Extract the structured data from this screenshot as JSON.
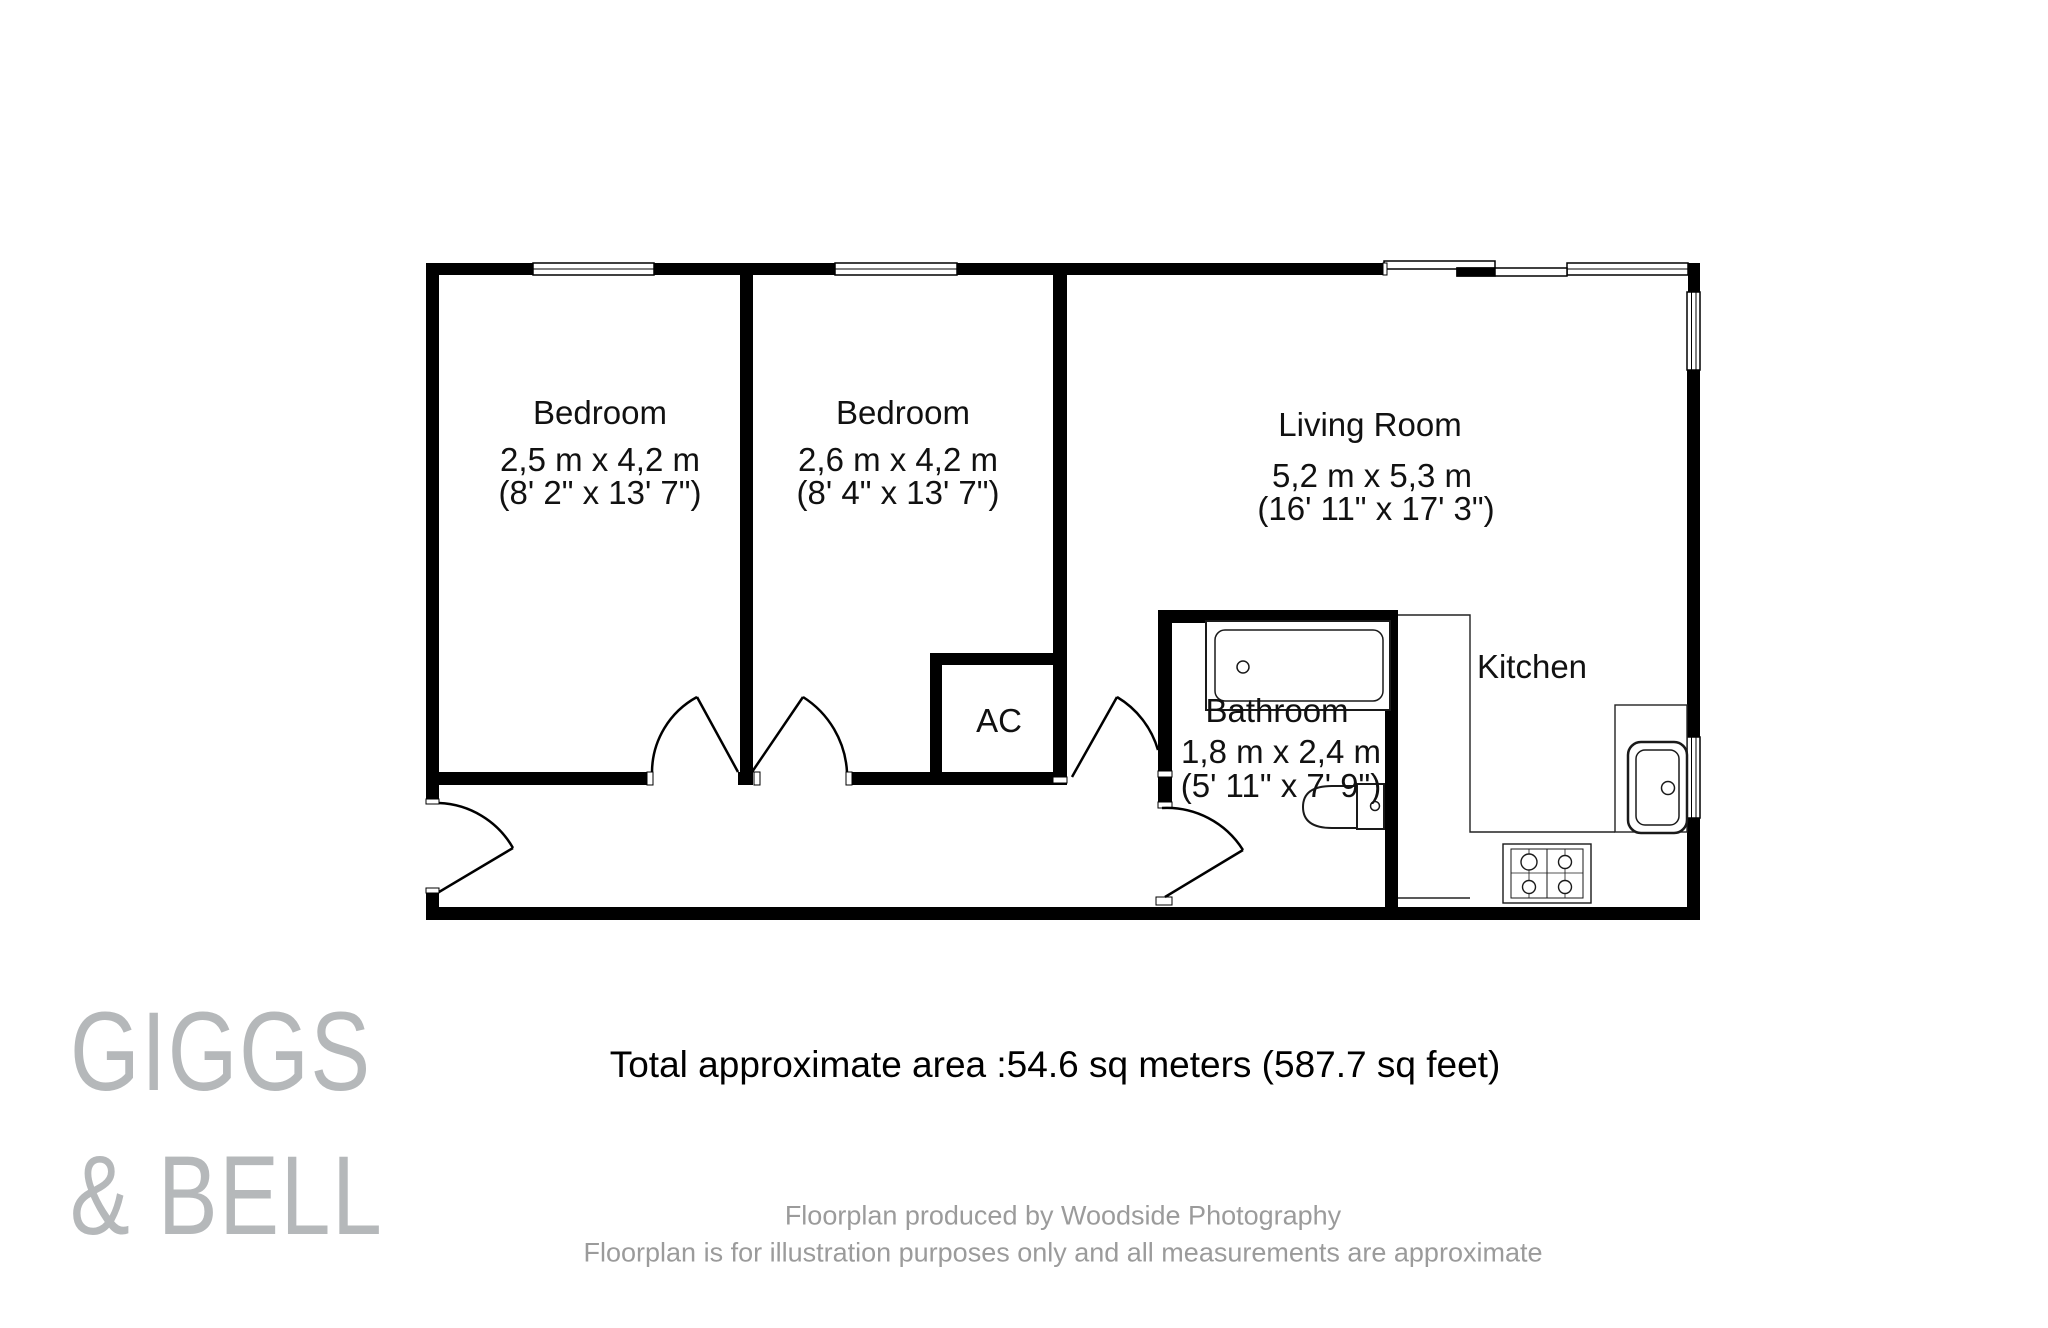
{
  "rooms": {
    "bedroom1": {
      "name": "Bedroom",
      "metric": "2,5 m x 4,2 m",
      "imperial": "(8' 2\" x 13' 7\")"
    },
    "bedroom2": {
      "name": "Bedroom",
      "metric": "2,6 m x 4,2 m",
      "imperial": "(8' 4\" x 13' 7\")"
    },
    "living": {
      "name": "Living Room",
      "metric": "5,2 m x 5,3 m",
      "imperial": "(16' 11\" x 17' 3\")"
    },
    "bathroom": {
      "name": "Bathroom",
      "metric": "1,8 m x 2,4 m",
      "imperial": "(5' 11\" x 7' 9\")"
    },
    "kitchen": {
      "name": "Kitchen"
    },
    "ac": {
      "name": "AC"
    }
  },
  "summary": {
    "total_area": "Total approximate area :54.6 sq meters (587.7 sq feet)"
  },
  "branding": {
    "line1": "GIGGS",
    "line2": "& BELL"
  },
  "footer": {
    "line1": "Floorplan produced by Woodside Photography",
    "line2": "Floorplan is for illustration purposes only and all measurements are approximate"
  },
  "colors": {
    "wall": "#000000",
    "fixture_line": "#1a1a1a",
    "logo_gray": "#b5b8ba",
    "footer_gray": "#9b9b9b"
  }
}
